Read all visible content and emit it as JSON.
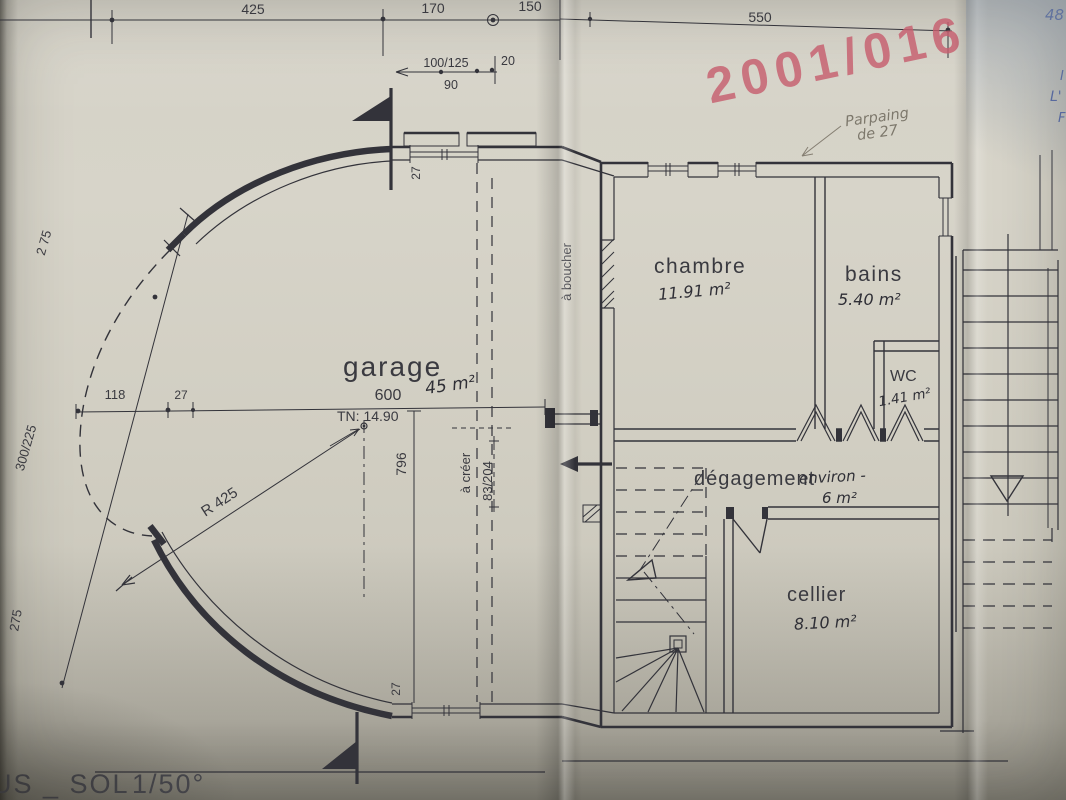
{
  "document": {
    "plan_title_fragment": "US _ SOL",
    "plan_scale": "1/50°",
    "stamp_number": "2001/016",
    "corner_handwritten": "48",
    "corner_blue_line1": "I",
    "corner_blue_line2": "L'",
    "corner_blue_line3": "F"
  },
  "pencil_note": {
    "line1": "Parpaing",
    "line2": "de 27"
  },
  "rooms": {
    "garage": {
      "name": "garage",
      "area": "45 m²"
    },
    "chambre": {
      "name": "chambre",
      "area": "11.91 m²"
    },
    "bains": {
      "name": "bains",
      "area": "5.40 m²"
    },
    "wc": {
      "name": "WC",
      "area": "1.41 m²"
    },
    "degagement": {
      "name": "dégagement",
      "qualifier": "environ -",
      "area": "6 m²"
    },
    "cellier": {
      "name": "cellier",
      "area": "8.10 m²"
    }
  },
  "annotations": {
    "a_boucher": "à boucher",
    "a_creer": "à créer",
    "a_creer_dim": "83/204",
    "tn_level": "TN: 14.90",
    "radius": "R 425"
  },
  "dimensions": {
    "top_425": "425",
    "top_170": "170",
    "top_150": "150",
    "top_550": "550",
    "lintel_100_125": "100/125",
    "lintel_90": "90",
    "lintel_20": "20",
    "left_275_upper": "2 75",
    "left_300_225": "300/225",
    "left_275_lower": "275",
    "garage_118": "118",
    "garage_27": "27",
    "garage_600": "600",
    "garage_796": "796",
    "jamb_top_27": "27",
    "jamb_bottom_27": "27"
  },
  "colors": {
    "ink": "#33333a",
    "stamp_red": "#c75f6f",
    "pencil_grey": "#7d786c",
    "blue_ink": "#4d5f9d",
    "paper": "#cfccc0"
  }
}
